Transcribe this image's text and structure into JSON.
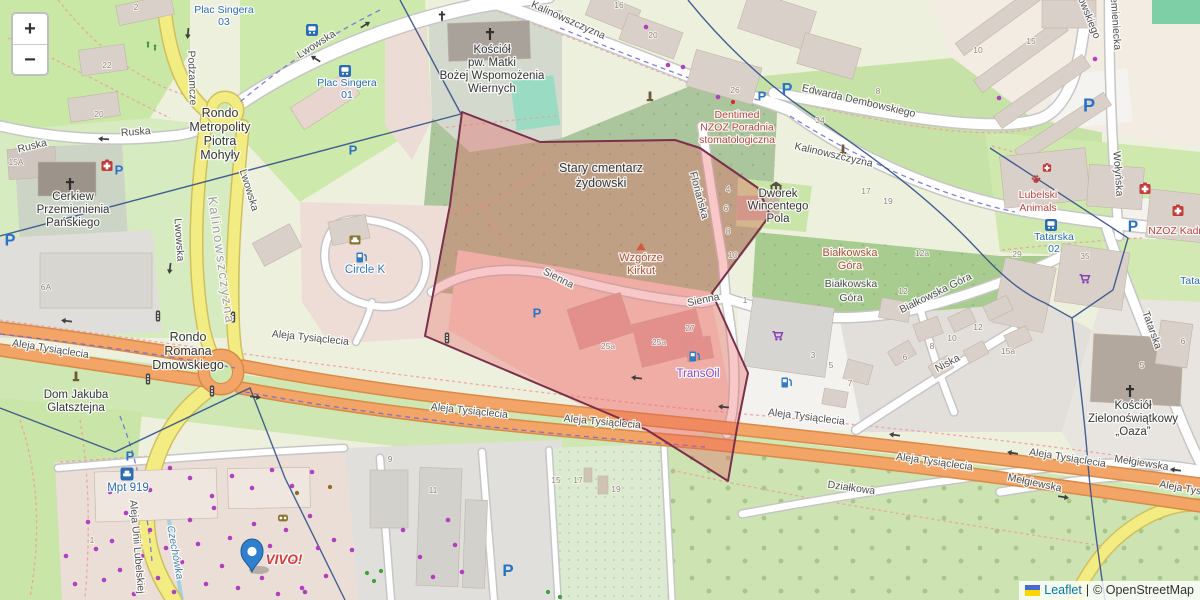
{
  "controls": {
    "zoom_in": "+",
    "zoom_out": "−"
  },
  "attribution": {
    "leaflet": "Leaflet",
    "separator": "|",
    "osm": "© OpenStreetMap"
  },
  "colors": {
    "street": "#4f4f4f",
    "locality": "#9d9d9d",
    "place": "#363636",
    "transit": "#2a6db5",
    "health": "#bc4540",
    "peak": "#b05038",
    "shop": "#8150c9",
    "fuel": "#2f7cc0",
    "water": "#5083a8",
    "retail": "#d93a35",
    "hn": "#8f8273",
    "overlay_fill": "rgba(233,84,88,0.33)",
    "overlay_stroke": "#7a2f4a",
    "admin_boundary": "#33518a",
    "marker": "#2f80cd",
    "road_orange": "#f2a566",
    "road_yellow": "#f3ec83",
    "attribution_link": "#0078a8",
    "flag_blue": "#4669d2",
    "flag_yellow": "#ffd500",
    "dot_purple": "#b040c0",
    "dot_green": "#3da23d",
    "dot_brown": "#8a6d1f",
    "dot_red": "#d22d2d"
  },
  "label_sizes": {
    "street": 10.5,
    "locality": 13,
    "place": 11.5,
    "transit": 10.5,
    "health": 10.5,
    "peak": 11,
    "shop": 11.5,
    "fuel": 11.5,
    "water": 10.5,
    "retail": 13.5
  },
  "labels": [
    {
      "t": "Ruska",
      "x": 33,
      "y": 149,
      "r": -14
    },
    {
      "t": "Ruska",
      "x": 136,
      "y": 135,
      "r": -4
    },
    {
      "t": "Lwowska",
      "x": 318,
      "y": 47,
      "r": -32
    },
    {
      "t": "Podzamcze",
      "x": 189,
      "y": 78,
      "r": 88
    },
    {
      "t": "Lwowska",
      "x": 176,
      "y": 240,
      "r": 86
    },
    {
      "t": "Lwowska",
      "x": 246,
      "y": 191,
      "r": 73
    },
    {
      "t": "Kalinowszczyzna",
      "x": 567,
      "y": 23,
      "r": 24
    },
    {
      "t": "Kalinowszczyzna",
      "x": 833,
      "y": 158,
      "r": 13
    },
    {
      "t": "Edwarda Dembowskiego",
      "x": 858,
      "y": 104,
      "r": 13
    },
    {
      "t": "Dembowskiego",
      "x": 1081,
      "y": 6,
      "r": 68
    },
    {
      "t": "Przemieniecka",
      "x": 1112,
      "y": 16,
      "r": 86
    },
    {
      "t": "Wołyńska",
      "x": 1115,
      "y": 174,
      "r": 86
    },
    {
      "t": "Floriańska",
      "x": 696,
      "y": 196,
      "r": 75
    },
    {
      "t": "Sienna",
      "x": 557,
      "y": 281,
      "r": 27
    },
    {
      "t": "Sienna",
      "x": 704,
      "y": 303,
      "r": -12
    },
    {
      "t": "Białkowska Góra",
      "x": 937,
      "y": 296,
      "r": -26
    },
    {
      "t": "Niska",
      "x": 949,
      "y": 366,
      "r": -28
    },
    {
      "t": "Tatarska",
      "x": 1149,
      "y": 331,
      "r": 70
    },
    {
      "t": "Aleja Tysiąclecia",
      "x": 50,
      "y": 352,
      "r": 9
    },
    {
      "t": "Aleja Tysiąclecia",
      "x": 310,
      "y": 341,
      "r": 6
    },
    {
      "t": "Aleja Tysiąclecia",
      "x": 469,
      "y": 414,
      "r": 6
    },
    {
      "t": "Aleja Tysiąclecia",
      "x": 602,
      "y": 425,
      "r": 5
    },
    {
      "t": "Aleja Tysiąclecia",
      "x": 806,
      "y": 420,
      "r": 7
    },
    {
      "t": "Aleja Tysiąclecia",
      "x": 934,
      "y": 465,
      "r": 8
    },
    {
      "t": "Aleja Tysiąclecia",
      "x": 1067,
      "y": 461,
      "r": 9
    },
    {
      "t": "Aleja Tysiąclecia",
      "x": 1197,
      "y": 494,
      "r": 10
    },
    {
      "t": "Mełgiewska",
      "x": 1034,
      "y": 486,
      "r": 12
    },
    {
      "t": "Mełgiewska",
      "x": 1141,
      "y": 466,
      "r": 9
    },
    {
      "t": "Działkowa",
      "x": 851,
      "y": 491,
      "r": 8
    },
    {
      "t": "Aleja Unii Lubelskiej",
      "x": 134,
      "y": 547,
      "r": 85
    },
    {
      "t": "Białkowska\nGóra",
      "x": 851,
      "y": 287,
      "lh": 14
    },
    {
      "t": "Kalinowszczyzna",
      "cls": "locality",
      "x": 217,
      "y": 261,
      "r": 82
    },
    {
      "t": "Czechówka",
      "cls": "water",
      "x": 172,
      "y": 553,
      "r": 80,
      "i": 1
    },
    {
      "t": "Rondo\nMetropolity\nPiotra\nMohyły",
      "cls": "place",
      "x": 220,
      "y": 117,
      "lh": 14,
      "s": 12.5
    },
    {
      "t": "Rondo\nRomana\nDmowskiego",
      "cls": "place",
      "x": 188,
      "y": 341,
      "lh": 14,
      "s": 12.5
    },
    {
      "t": "Kościół\npw. Matki\nBożej Wspomożenia\nWiernych",
      "cls": "place",
      "x": 492,
      "y": 53,
      "lh": 13
    },
    {
      "t": "Cerkiew\nPrzemienienia\nPańskiego",
      "cls": "place",
      "x": 73,
      "y": 200,
      "lh": 13
    },
    {
      "t": "Stary cmentarz\nżydowski",
      "cls": "place",
      "x": 601,
      "y": 172,
      "lh": 15,
      "s": 12.5
    },
    {
      "t": "Dworek\nWincentego\nPola",
      "cls": "place",
      "x": 778,
      "y": 197,
      "lh": 12.5
    },
    {
      "t": "Kościół\nZielonoświątkowy\n„Oaza”",
      "cls": "place",
      "x": 1133,
      "y": 409,
      "lh": 13
    },
    {
      "t": "Dom Jakuba\nGlatsztejna",
      "cls": "place",
      "x": 76,
      "y": 398,
      "lh": 13
    },
    {
      "t": "Plac Singera\n03",
      "cls": "transit",
      "x": 224,
      "y": 13,
      "lh": 12
    },
    {
      "t": "Plac Singera\n01",
      "cls": "transit",
      "x": 347,
      "y": 86,
      "lh": 12
    },
    {
      "t": "Tatarska\n02",
      "cls": "transit",
      "x": 1054,
      "y": 240,
      "lh": 12
    },
    {
      "t": "Tatarska",
      "cls": "transit",
      "x": 1200,
      "y": 284
    },
    {
      "t": "Mpt 919",
      "cls": "transit",
      "x": 128,
      "y": 491,
      "s": 11.5
    },
    {
      "t": "Dentimed\nNZOZ Poradnia\nstomatologiczna",
      "cls": "health",
      "x": 737,
      "y": 118,
      "lh": 12.5
    },
    {
      "t": "NZOZ Kadre",
      "cls": "health",
      "x": 1178,
      "y": 234
    },
    {
      "t": "Lubelski\nAnimals",
      "cls": "health",
      "x": 1038,
      "y": 198,
      "lh": 13
    },
    {
      "t": "Wzgórze\nKirkut",
      "cls": "peak",
      "x": 641,
      "y": 261,
      "lh": 13
    },
    {
      "t": "Białkowska\nGóra",
      "cls": "peak",
      "x": 850,
      "y": 256,
      "lh": 13
    },
    {
      "t": "TransOil",
      "cls": "shop",
      "x": 698,
      "y": 377
    },
    {
      "t": "Circle K",
      "cls": "fuel",
      "x": 365,
      "y": 273
    },
    {
      "t": "VIVO!",
      "cls": "retail",
      "x": 284,
      "y": 564,
      "b": 1,
      "i": 1
    }
  ],
  "housenumbers": [
    [
      107,
      68,
      "22"
    ],
    [
      99,
      117,
      "20"
    ],
    [
      136,
      10,
      "2"
    ],
    [
      16,
      165,
      "15A"
    ],
    [
      46,
      290,
      "6A"
    ],
    [
      619,
      8,
      "16"
    ],
    [
      653,
      38,
      "20"
    ],
    [
      735,
      93,
      "26"
    ],
    [
      820,
      123,
      "34"
    ],
    [
      878,
      94,
      "8"
    ],
    [
      866,
      194,
      "17"
    ],
    [
      888,
      204,
      "19"
    ],
    [
      978,
      53,
      "10"
    ],
    [
      1031,
      44,
      "15"
    ],
    [
      1017,
      257,
      "29"
    ],
    [
      1085,
      259,
      "35"
    ],
    [
      922,
      256,
      "12a"
    ],
    [
      903,
      294,
      "12"
    ],
    [
      978,
      330,
      "12"
    ],
    [
      952,
      341,
      "10"
    ],
    [
      932,
      349,
      "8"
    ],
    [
      905,
      360,
      "6"
    ],
    [
      850,
      386,
      "7"
    ],
    [
      813,
      358,
      "3"
    ],
    [
      831,
      368,
      "5"
    ],
    [
      1008,
      354,
      "15a"
    ],
    [
      728,
      192,
      "4"
    ],
    [
      726,
      211,
      "6"
    ],
    [
      728,
      234,
      "8"
    ],
    [
      733,
      258,
      "10"
    ],
    [
      608,
      349,
      "25a"
    ],
    [
      659,
      345,
      "25a"
    ],
    [
      690,
      331,
      "27"
    ],
    [
      745,
      303,
      "1"
    ],
    [
      390,
      462,
      "9"
    ],
    [
      433,
      493,
      "11"
    ],
    [
      556,
      483,
      "15"
    ],
    [
      578,
      483,
      "17"
    ],
    [
      616,
      492,
      "19"
    ],
    [
      92,
      543,
      "1"
    ],
    [
      1142,
      368,
      "5"
    ],
    [
      1183,
      344,
      "6"
    ]
  ],
  "icons": [
    {
      "k": "parking",
      "x": 119,
      "y": 170
    },
    {
      "k": "parking",
      "x": 10,
      "y": 240,
      "s": 1.25
    },
    {
      "k": "parking",
      "x": 353,
      "y": 150
    },
    {
      "k": "parking",
      "x": 762,
      "y": 96
    },
    {
      "k": "parking",
      "x": 787,
      "y": 89,
      "s": 1.25
    },
    {
      "k": "parking",
      "x": 1089,
      "y": 105,
      "s": 1.4
    },
    {
      "k": "parking",
      "x": 1133,
      "y": 226,
      "s": 1.2
    },
    {
      "k": "parking",
      "x": 130,
      "y": 456
    },
    {
      "k": "parking",
      "x": 508,
      "y": 570,
      "s": 1.3
    },
    {
      "k": "parking",
      "x": 537,
      "y": 313
    },
    {
      "k": "bus",
      "x": 312,
      "y": 30
    },
    {
      "k": "bus",
      "x": 345,
      "y": 71
    },
    {
      "k": "bus",
      "x": 1051,
      "y": 225
    },
    {
      "k": "taxi",
      "x": 127,
      "y": 474
    },
    {
      "k": "fuel",
      "x": 361,
      "y": 258
    },
    {
      "k": "fuel",
      "x": 694,
      "y": 357
    },
    {
      "k": "fuel",
      "x": 786,
      "y": 383
    },
    {
      "k": "carwash",
      "x": 355,
      "y": 240
    },
    {
      "k": "peak",
      "x": 641,
      "y": 247
    },
    {
      "k": "museum",
      "x": 776,
      "y": 188
    },
    {
      "k": "monument",
      "x": 650,
      "y": 97
    },
    {
      "k": "monument",
      "x": 843,
      "y": 150
    },
    {
      "k": "monument",
      "x": 76,
      "y": 377
    },
    {
      "k": "viewpoint",
      "x": 283,
      "y": 518
    },
    {
      "k": "church",
      "x": 490,
      "y": 34
    },
    {
      "k": "church",
      "x": 70,
      "y": 184
    },
    {
      "k": "church",
      "x": 1130,
      "y": 391
    },
    {
      "k": "church",
      "x": 442,
      "y": 16,
      "s": 0.8
    },
    {
      "k": "hospital",
      "x": 107,
      "y": 166
    },
    {
      "k": "hospital",
      "x": 1145,
      "y": 189
    },
    {
      "k": "hospital",
      "x": 1178,
      "y": 211
    },
    {
      "k": "hospital",
      "x": 1047,
      "y": 168,
      "s": 0.75
    },
    {
      "k": "paw",
      "x": 1036,
      "y": 179
    },
    {
      "k": "cart",
      "x": 777,
      "y": 336
    },
    {
      "k": "cart",
      "x": 1084,
      "y": 279
    },
    {
      "k": "traffic",
      "x": 158,
      "y": 316
    },
    {
      "k": "traffic",
      "x": 233,
      "y": 317
    },
    {
      "k": "traffic",
      "x": 148,
      "y": 379
    },
    {
      "k": "traffic",
      "x": 212,
      "y": 391
    },
    {
      "k": "traffic",
      "x": 447,
      "y": 338
    },
    {
      "k": "greenfig",
      "x": 148,
      "y": 45
    },
    {
      "k": "greenfig",
      "x": 155,
      "y": 48
    },
    {
      "k": "arrow",
      "x": 104,
      "y": 139,
      "r": 184
    },
    {
      "k": "arrow",
      "x": 316,
      "y": 59,
      "r": 212
    },
    {
      "k": "arrow",
      "x": 188,
      "y": 33,
      "r": 95
    },
    {
      "k": "arrow",
      "x": 365,
      "y": 25,
      "r": -32
    },
    {
      "k": "arrow",
      "x": 170,
      "y": 268,
      "r": 97
    },
    {
      "k": "arrow",
      "x": 67,
      "y": 321,
      "r": 187
    },
    {
      "k": "arrow",
      "x": 255,
      "y": 397,
      "r": 7
    },
    {
      "k": "arrow",
      "x": 637,
      "y": 378,
      "r": 187
    },
    {
      "k": "arrow",
      "x": 724,
      "y": 407,
      "r": 186
    },
    {
      "k": "arrow",
      "x": 895,
      "y": 435,
      "r": 188
    },
    {
      "k": "arrow",
      "x": 1013,
      "y": 453,
      "r": 189
    },
    {
      "k": "arrow",
      "x": 1063,
      "y": 497,
      "r": 9
    },
    {
      "k": "arrow",
      "x": 1176,
      "y": 470,
      "r": 188
    }
  ],
  "dots": {
    "purple": [
      [
        646,
        27
      ],
      [
        668,
        65
      ],
      [
        683,
        67
      ],
      [
        718,
        97
      ],
      [
        999,
        98
      ],
      [
        1095,
        59
      ],
      [
        66,
        556
      ],
      [
        75,
        584
      ],
      [
        88,
        522
      ],
      [
        96,
        549
      ],
      [
        104,
        580
      ],
      [
        112,
        541
      ],
      [
        120,
        570
      ],
      [
        126,
        513
      ],
      [
        134,
        594
      ],
      [
        142,
        556
      ],
      [
        150,
        530
      ],
      [
        158,
        578
      ],
      [
        166,
        548
      ],
      [
        174,
        592
      ],
      [
        182,
        562
      ],
      [
        190,
        520
      ],
      [
        198,
        544
      ],
      [
        206,
        584
      ],
      [
        214,
        508
      ],
      [
        222,
        566
      ],
      [
        230,
        538
      ],
      [
        238,
        588
      ],
      [
        246,
        556
      ],
      [
        254,
        524
      ],
      [
        262,
        578
      ],
      [
        270,
        546
      ],
      [
        278,
        594
      ],
      [
        286,
        530
      ],
      [
        294,
        562
      ],
      [
        302,
        588
      ],
      [
        310,
        516
      ],
      [
        318,
        548
      ],
      [
        326,
        576
      ],
      [
        334,
        540
      ],
      [
        212,
        496
      ],
      [
        232,
        476
      ],
      [
        252,
        488
      ],
      [
        272,
        470
      ],
      [
        292,
        486
      ],
      [
        312,
        472
      ],
      [
        305,
        592
      ],
      [
        190,
        478
      ],
      [
        170,
        468
      ],
      [
        150,
        490
      ],
      [
        130,
        470
      ],
      [
        110,
        492
      ],
      [
        403,
        530
      ],
      [
        420,
        557
      ],
      [
        433,
        577
      ],
      [
        352,
        550
      ],
      [
        448,
        520
      ],
      [
        455,
        545
      ],
      [
        462,
        572
      ]
    ],
    "green": [
      [
        367,
        573
      ],
      [
        374,
        581
      ],
      [
        381,
        571
      ],
      [
        548,
        592
      ],
      [
        560,
        597
      ]
    ],
    "brown": [
      [
        297,
        493
      ],
      [
        330,
        487
      ]
    ],
    "red": [
      [
        733,
        102
      ]
    ]
  }
}
